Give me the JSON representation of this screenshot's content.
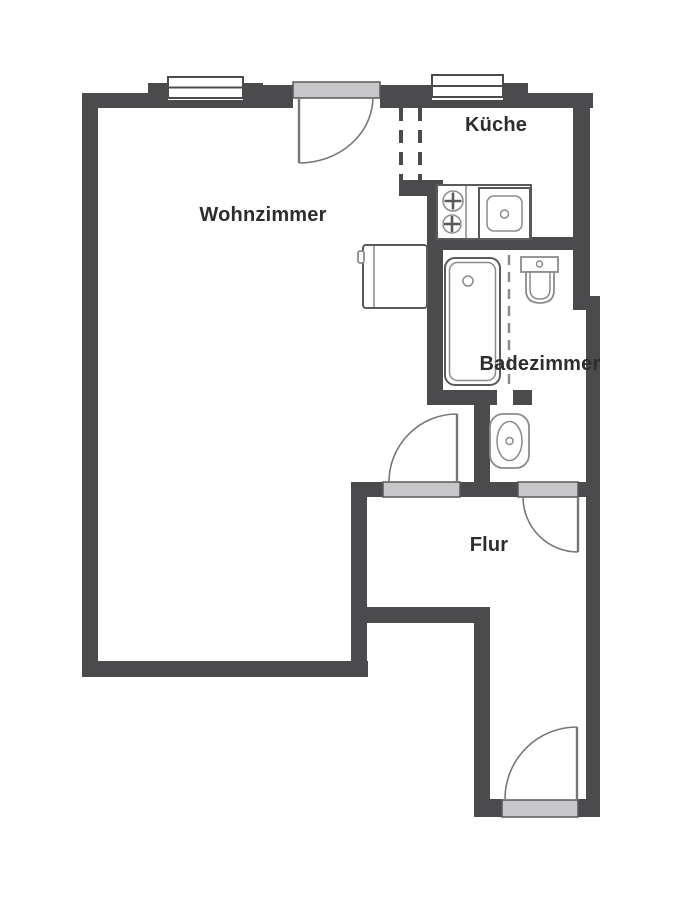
{
  "app": {
    "type": "apartment-floor-plan"
  },
  "rooms": {
    "wohnzimmer": {
      "label": "Wohnzimmer"
    },
    "kueche": {
      "label": "Küche"
    },
    "badezimmer": {
      "label": "Badezimmer"
    },
    "flur": {
      "label": "Flur"
    }
  },
  "fixtures": [
    "window-living-room",
    "window-kitchen",
    "balcony-door",
    "open-passage-dashed",
    "kitchen-counter",
    "stove-burners",
    "kitchen-sink",
    "cabinet",
    "bathtub",
    "shower-partition-dashed",
    "washbasin",
    "toilet",
    "door-living-room-hall",
    "door-bathroom-hall",
    "entry-door",
    "door-threshold-living-room",
    "door-threshold-bathroom",
    "door-threshold-entry"
  ],
  "colors": {
    "wall": "#4b4b4d",
    "threshold_fill": "#c7c7c9",
    "threshold_border": "#58585a",
    "fixture_outline": "#8b8b8d",
    "fixture_dark": "#5a5a5c",
    "door_swing": "#76767a",
    "label_text": "#2d2d2f",
    "background": "#ffffff"
  }
}
